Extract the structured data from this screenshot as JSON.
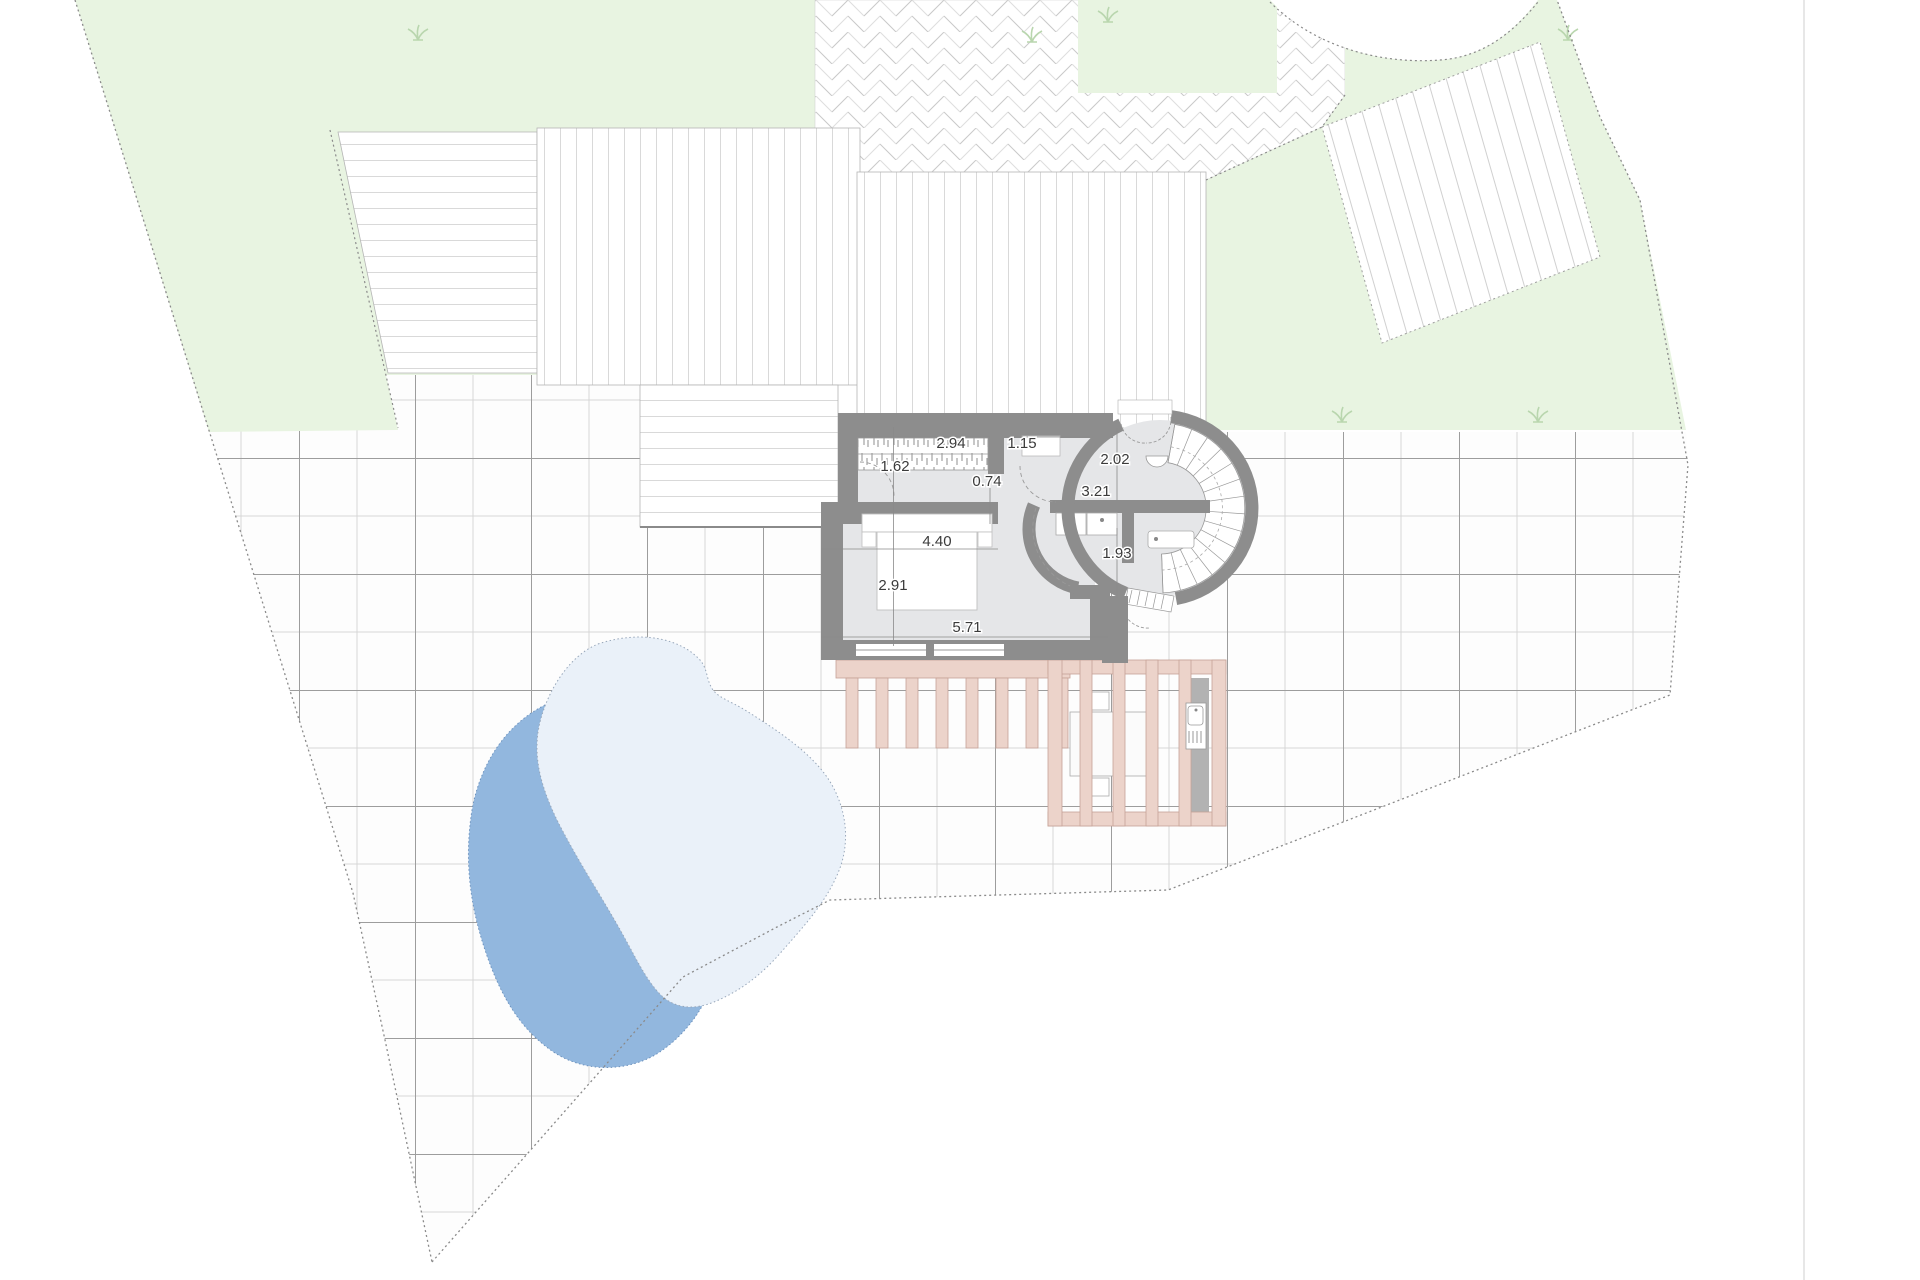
{
  "plan": {
    "dimensions": [
      {
        "value": "2.94"
      },
      {
        "value": "1.15"
      },
      {
        "value": "2.02"
      },
      {
        "value": "1.62"
      },
      {
        "value": "0.74"
      },
      {
        "value": "3.21"
      },
      {
        "value": "4.40"
      },
      {
        "value": "1.93"
      },
      {
        "value": "2.91"
      },
      {
        "value": "5.71"
      }
    ],
    "colors": {
      "grass_green": "#e8f4e1",
      "grass_symbol": "#b9d6ae",
      "pool_water_dark": "#92b7de",
      "pool_water_light": "#eaf1f9",
      "wall_gray": "#8d8d8d",
      "room_floor": "#e5e6e8",
      "pergola_wood": "#ecd3ca",
      "pergola_edge": "#c6a296",
      "counter_gray": "#b2b2b2",
      "tile_line_light": "#d6d6d6",
      "tile_line_dark": "#9d9d9d",
      "boundary_gray": "#8a8a8a"
    }
  }
}
